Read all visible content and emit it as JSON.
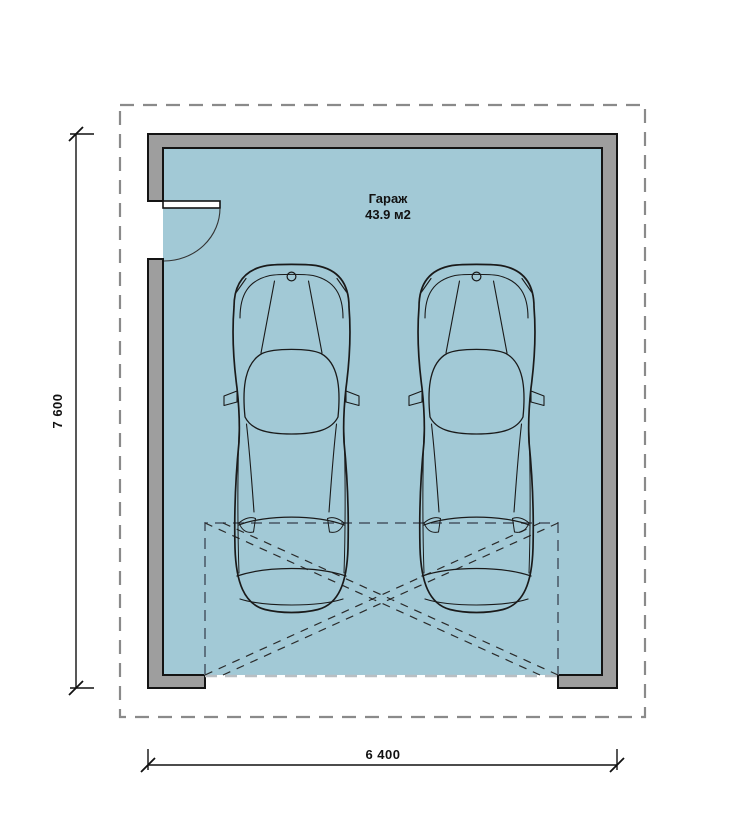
{
  "plan": {
    "room": {
      "name": "Гараж",
      "area": "43.9 м2"
    },
    "dimensions": {
      "vertical": "7 600",
      "horizontal": "6 400"
    },
    "colors": {
      "background": "#ffffff",
      "floor": "#a2c9d6",
      "wall_fill": "#9e9e9e",
      "wall_outline": "#141414",
      "boundary_dash": "#8a8a8a",
      "door_zone_dash": "#5e7280",
      "opening_dash": "#b9bfc3",
      "diagonal_dash": "#2a2a2a",
      "car_line": "#1a1a1a",
      "dimension_line": "#111111",
      "door_arc": "#333333"
    }
  }
}
